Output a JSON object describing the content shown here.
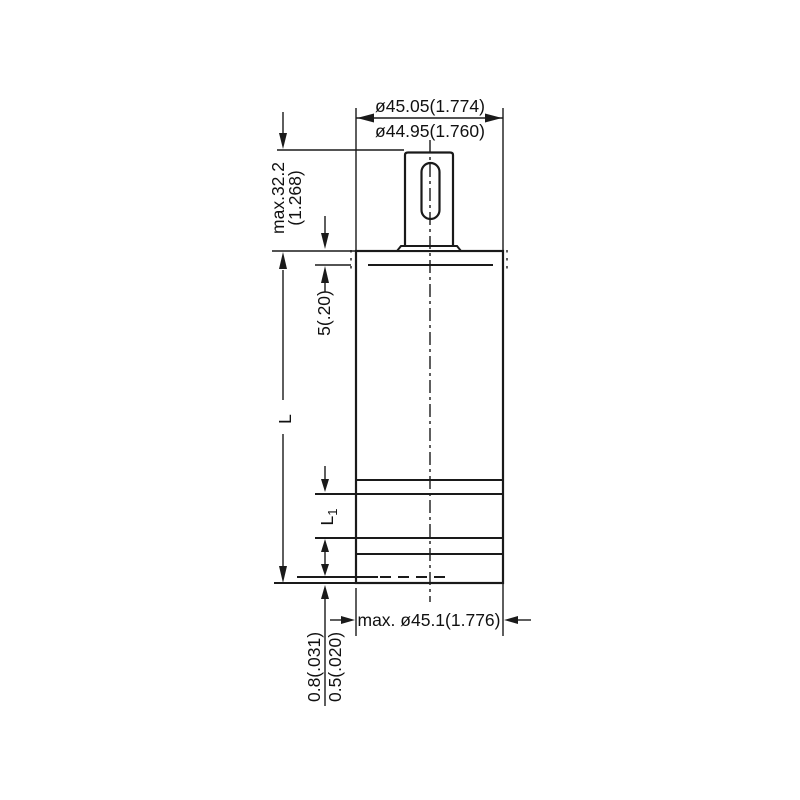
{
  "diagram": {
    "background": "#ffffff",
    "line_color": "#1a1a1a",
    "dims": {
      "top_dia_max": "ø45.05(1.774)",
      "top_dia_min": "ø44.95(1.760)",
      "terminal_h": "max.32.2",
      "terminal_h_in": "(1.268)",
      "shoulder": "5(.20)",
      "length": "L",
      "length1_main": "L",
      "length1_sub": "1",
      "standoff_num": "0.8(.031)",
      "standoff_den": "0.5(.020)",
      "bottom_dia": "max. ø45.1(1.776)"
    }
  }
}
